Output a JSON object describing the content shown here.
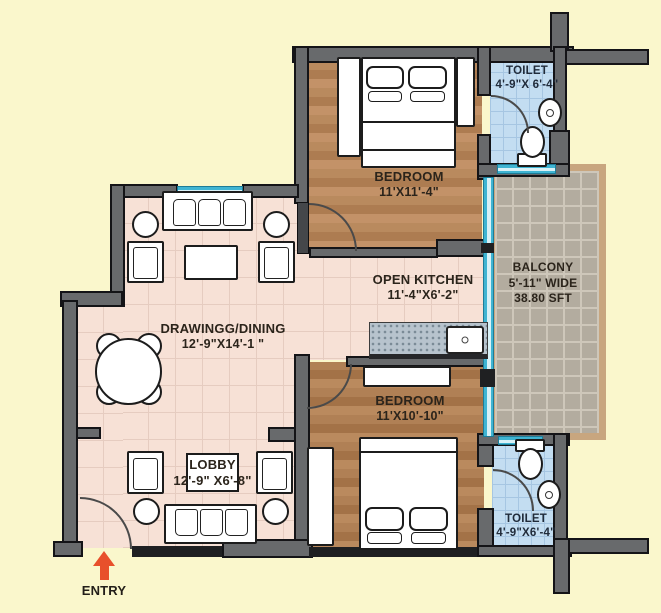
{
  "rooms": {
    "bedroom_top": {
      "name": "BEDROOM",
      "dims": "11'X11'-4\""
    },
    "toilet_top": {
      "name": "TOILET",
      "dims": "4'-9\"X 6'-4\""
    },
    "balcony": {
      "name": "BALCONY",
      "width_note": "5'-11\" WIDE",
      "area": "38.80 SFT"
    },
    "open_kitchen": {
      "name": "OPEN KITCHEN",
      "dims": "11'-4\"X6'-2\""
    },
    "drawing_dining": {
      "name": "DRAWINGG/DINING",
      "dims": "12'-9\"X14'-1 \""
    },
    "lobby": {
      "name": "LOBBY",
      "dims": "12'-9\" X6'-8\""
    },
    "bedroom_bottom": {
      "name": "BEDROOM",
      "dims": "11'X10'-10\""
    },
    "toilet_bottom": {
      "name": "TOILET",
      "dims": "4'-9\"X6'-4\""
    }
  },
  "entry": {
    "label": "ENTRY"
  },
  "colors": {
    "background": "#FAF7CC",
    "wall": "#686A6C",
    "wood_floor": "#B5845B",
    "living_tile": "#F7E1D6",
    "toilet_floor": "#C3DDF1",
    "balcony_tile": "#B3AC9F",
    "balcony_border": "#C8A67F",
    "window_glass": "#3FB4D2",
    "kitchen_counter": "#B7C3CD",
    "entry_arrow": "#E8502B",
    "label_text": "#2B241B"
  }
}
